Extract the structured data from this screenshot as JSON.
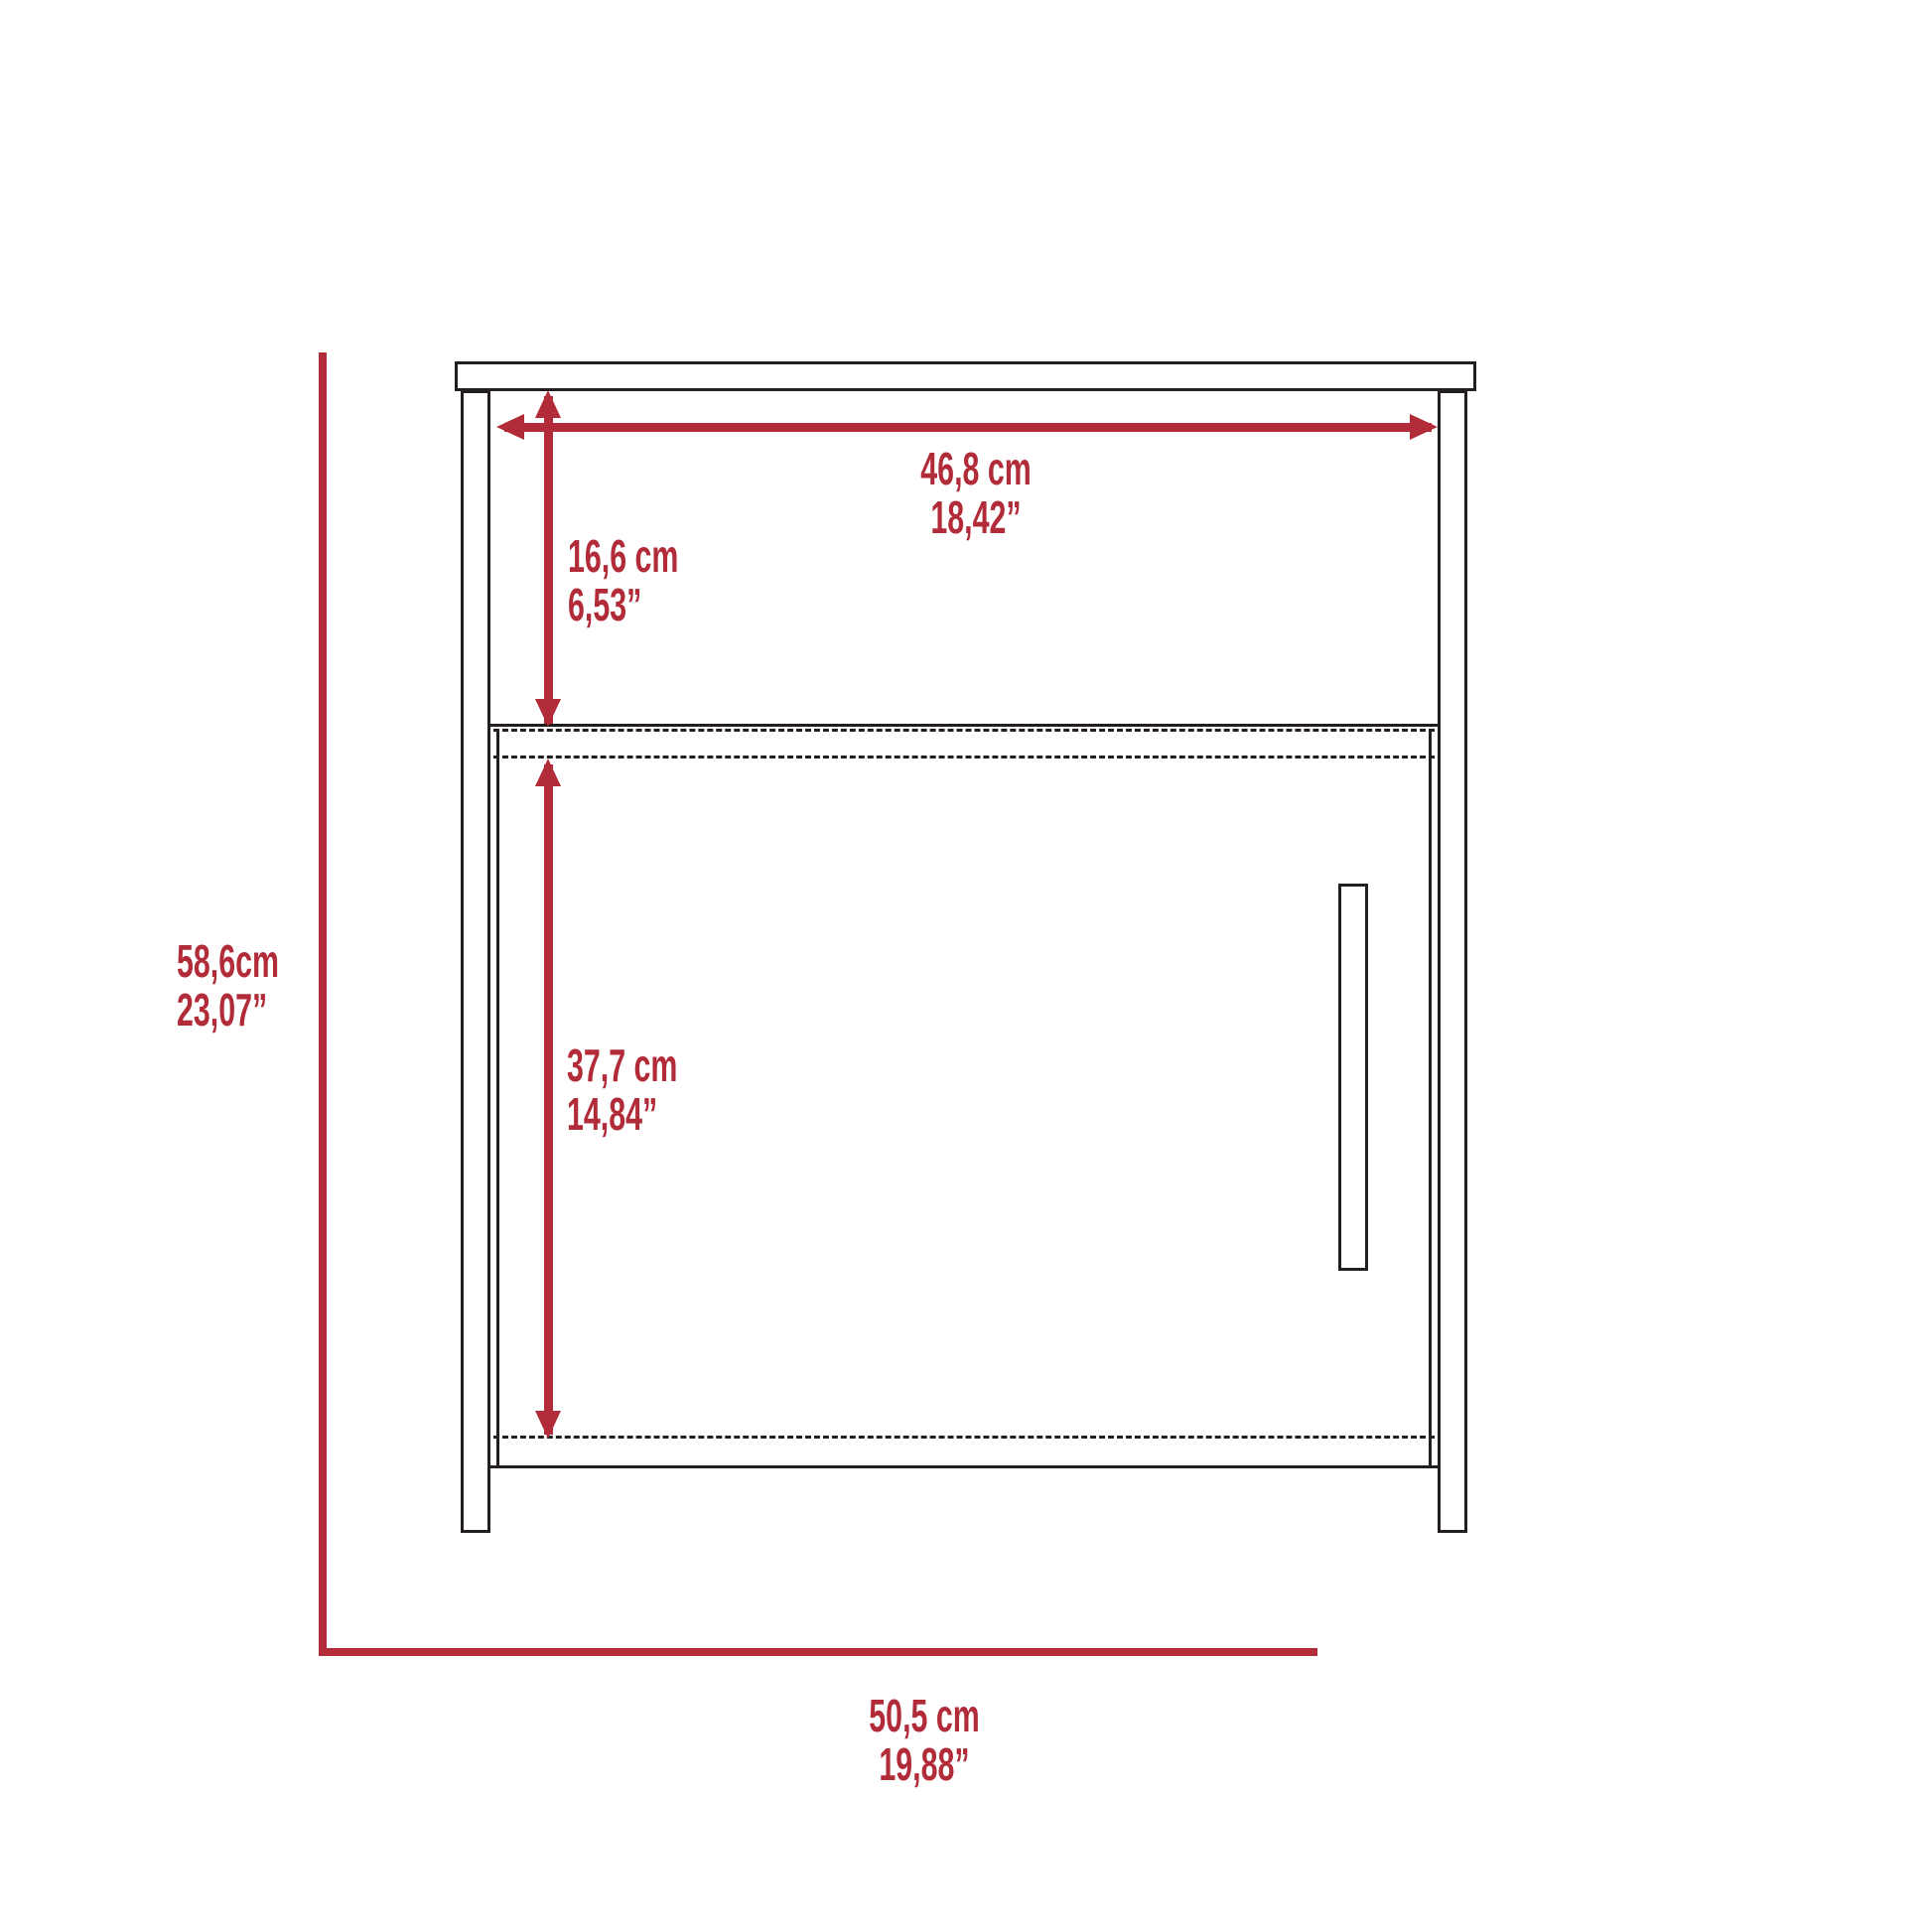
{
  "diagram_title": "nightstand-dimension-drawing",
  "colors": {
    "dimension_red": "#B12B38",
    "line_black": "#231F20",
    "background": "#FFFFFF"
  },
  "labels": {
    "inner_width_cm": "46,8 cm",
    "inner_width_in": "18,42”",
    "shelf_height_cm": "16,6 cm",
    "shelf_height_in": "6,53”",
    "door_height_cm": "37,7 cm",
    "door_height_in": "14,84”",
    "overall_height_cm": "58,6cm",
    "overall_height_in": "23,07”",
    "overall_width_cm": "50,5 cm",
    "overall_width_in": "19,88”"
  }
}
